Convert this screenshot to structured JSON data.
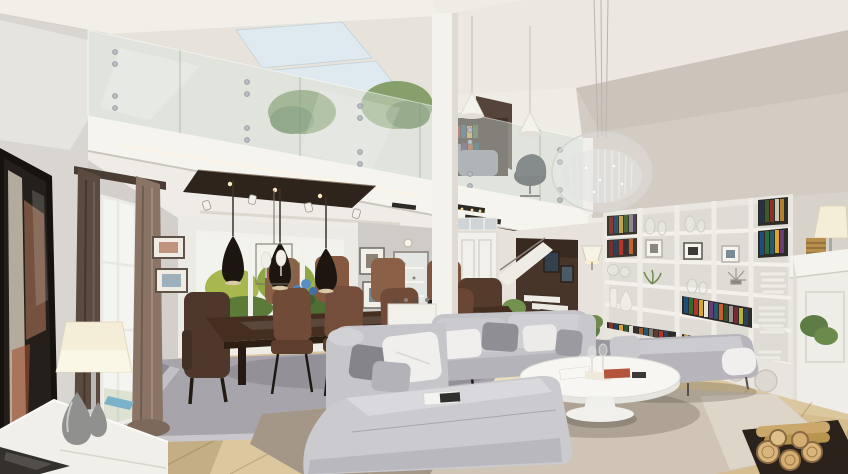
{
  "meta": {
    "kind": "photorealistic interior render",
    "description": "Open-plan double-height living room with mezzanine, glass balustrade, skylights, dining area, gray sectional sofa, white oval coffee table, built-in white bookshelf, staircase with dark accent wall and white fireplace.",
    "width_px": 848,
    "height_px": 474
  },
  "scene": {
    "room": "open-plan living room with mezzanine",
    "objects": [
      "sloped ceiling",
      "skylight windows",
      "glass balustrade with steel bolts",
      "mezzanine indoor trees",
      "mezzanine bookcase",
      "office chair",
      "crystal oval chandelier",
      "white cone pendant lights",
      "wall TV with reflection",
      "brown curtains",
      "tall window",
      "framed pictures",
      "table lamp",
      "white gloss sideboard",
      "silver teardrop vases",
      "dark wood dining table",
      "brown leather dining chairs",
      "black teardrop pendant lamps",
      "dark ceiling recess with spotlights",
      "garden-view glass partition",
      "blue flower centerpiece",
      "white entry door",
      "wall mirror console",
      "staircase",
      "dark brown accent wall",
      "potted plants",
      "wall sconce",
      "built-in white bookshelf",
      "colorful books",
      "decor vases and frames",
      "gray fabric daybed",
      "corner sectional sofa",
      "throw pillows",
      "oval white pedestal coffee table",
      "wine glasses",
      "magazines",
      "taupe living-area rug",
      "gray dining rug",
      "light oak plank floor",
      "white fireplace mantel",
      "mantel lamp",
      "stacked firewood"
    ]
  },
  "colors": {
    "ceiling_light": "#f2efe9",
    "ceiling_mid": "#e7e3db",
    "ceiling_right": "#ece8e1",
    "wall_sloped": "#d2ccc3",
    "wall_left": "#d9d6d1",
    "wall_mid": "#d3cfca",
    "wall_beige": "#d8d3ca",
    "skylight": "#dfeaf0",
    "glass_tint": "rgba(213,226,219,0.45)",
    "fascia_white": "#f6f4ef",
    "post_white": "#f4f2ed",
    "recess_panel": "#2f241c",
    "partition_white": "#eceae5",
    "garden_bg": "#f1f3ec",
    "foliage_light": "#a8b84e",
    "foliage_dark": "#5c7b38",
    "curtain_dark": "#5a4a3f",
    "curtain_light": "#8a7466",
    "tv_frame": "#15120f",
    "lamp_shade": "#f4eed9",
    "sideboard_white": "#f1efe9",
    "vase_silver": "#90908e",
    "table_wood": "#442e20",
    "chair_brown": "#6f4b38",
    "chair_brown_light": "#8a6047",
    "chair_brown_dark": "#543b2c",
    "pendant_black": "#1d1510",
    "rug_dining": "#a7a5ab",
    "rug_living": "#cfc4b5",
    "sofa_fabric": "#c4c3c8",
    "chaise_fabric": "#cbcacf",
    "daybed_fabric": "#b7b5bb",
    "pillow_white": "#f0efed",
    "pillow_gray": "#8f8e94",
    "coffee_table_white": "#f7f6f3",
    "floor_wood": "#dcc89e",
    "stair_wall": "#47352a",
    "door_white": "#f2f0ec",
    "entry_wall": "#e6e2da",
    "mirror_wall": "#cfccc7",
    "bookshelf_white": "#eae7e1",
    "fireplace_white": "#efede7",
    "mantel_white": "#f5f3ee",
    "plant_green": "#5e7c46",
    "sconce_shade": "#f6f2e4",
    "firewood": "#d9b57c",
    "book_spine_colors": [
      "#8a3b2f",
      "#32556e",
      "#c2a24a",
      "#49683c",
      "#1f4d7a",
      "#b5342a",
      "#d9a62e",
      "#6b3b7a",
      "#27586b",
      "#c4622f",
      "#e8e4da",
      "#343230"
    ]
  }
}
